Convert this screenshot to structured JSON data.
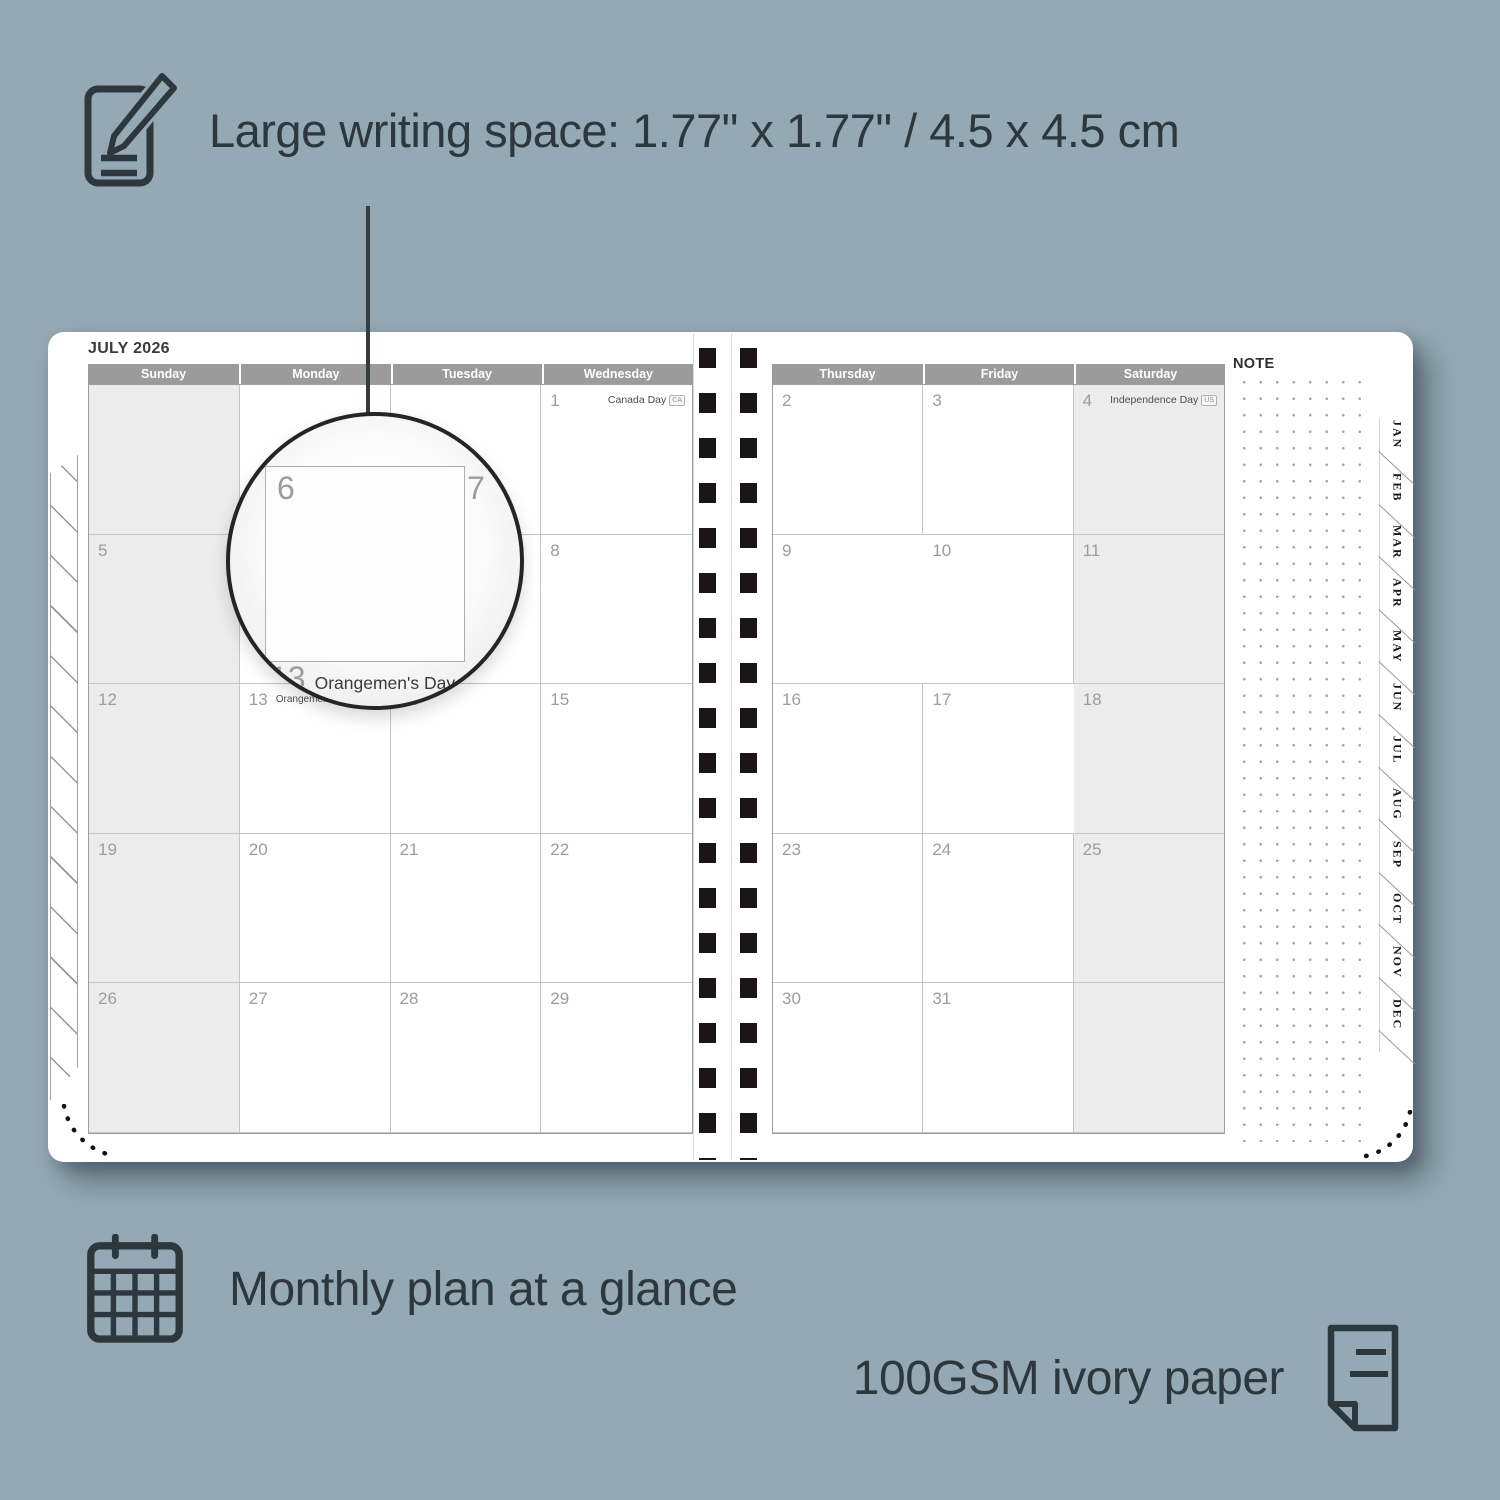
{
  "colors": {
    "background": "#94a9b4",
    "ink": "#2d383e",
    "header_bg": "#9b9b9b",
    "shaded_cell": "#ececec",
    "page": "#ffffff",
    "binding_hole": "#1c1517"
  },
  "annotations": {
    "writing_space": "Large writing space: 1.77\" x 1.77\" / 4.5 x 4.5 cm",
    "monthly_plan": "Monthly plan at a glance",
    "paper": "100GSM ivory paper"
  },
  "icons": {
    "top": "pencil-note-icon",
    "bottom_left": "calendar-grid-icon",
    "bottom_right": "paper-sheet-icon"
  },
  "planner": {
    "month_title": "JULY 2026",
    "note_label": "NOTE",
    "left_day_headers": [
      "Sunday",
      "Monday",
      "Tuesday",
      "Wednesday"
    ],
    "right_day_headers": [
      "Thursday",
      "Friday",
      "Saturday"
    ],
    "left_shaded_col": 0,
    "right_shaded_col": 2,
    "month_tabs": [
      "JAN",
      "FEB",
      "MAR",
      "APR",
      "MAY",
      "JUN",
      "JUL",
      "AUG",
      "SEP",
      "OCT",
      "NOV",
      "DEC"
    ],
    "left_rows": [
      [
        {
          "day": ""
        },
        {
          "day": ""
        },
        {
          "day": ""
        },
        {
          "day": "1",
          "event": "Canada Day",
          "badge": "CA"
        }
      ],
      [
        {
          "day": "5"
        },
        {
          "day": "6"
        },
        {
          "day": "7"
        },
        {
          "day": "8"
        }
      ],
      [
        {
          "day": "12"
        },
        {
          "day": "13",
          "event": "Orangemen's Day (n.i.)",
          "badge": "UK",
          "event_align": "left"
        },
        {
          "day": "14"
        },
        {
          "day": "15"
        }
      ],
      [
        {
          "day": "19"
        },
        {
          "day": "20"
        },
        {
          "day": "21"
        },
        {
          "day": "22"
        }
      ],
      [
        {
          "day": "26"
        },
        {
          "day": "27"
        },
        {
          "day": "28"
        },
        {
          "day": "29"
        }
      ]
    ],
    "right_rows": [
      [
        {
          "day": "2"
        },
        {
          "day": "3"
        },
        {
          "day": "4",
          "event": "Independence Day",
          "badge": "US"
        }
      ],
      [
        {
          "day": "9"
        },
        {
          "day": "10"
        },
        {
          "day": "11"
        }
      ],
      [
        {
          "day": "16"
        },
        {
          "day": "17"
        },
        {
          "day": "18"
        }
      ],
      [
        {
          "day": "23"
        },
        {
          "day": "24"
        },
        {
          "day": "25"
        }
      ],
      [
        {
          "day": "30"
        },
        {
          "day": "31"
        },
        {
          "day": ""
        }
      ]
    ],
    "magnifier": {
      "day_left": "6",
      "day_right": "7",
      "footer_day": "13",
      "footer_event": "Orangemen's Day (n.i.)",
      "footer_badge": "UK"
    }
  }
}
